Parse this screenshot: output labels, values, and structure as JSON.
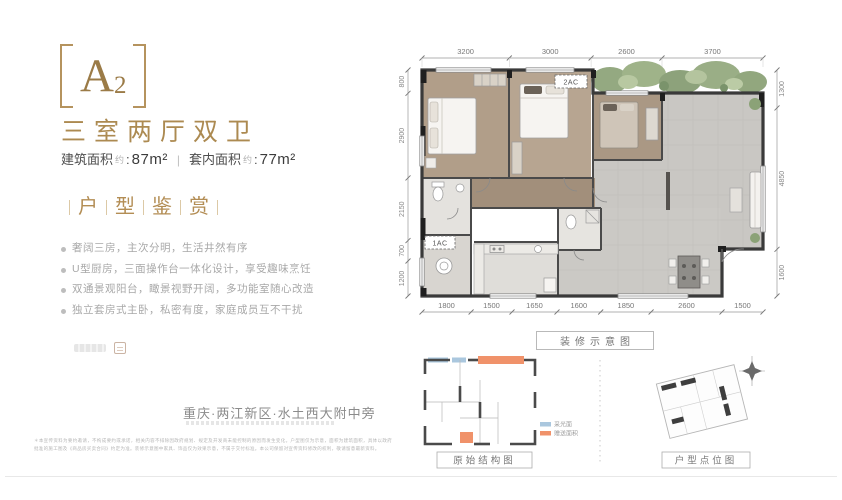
{
  "page": {
    "accent_gold": "#ac8a51",
    "wall_color": "#3a3a3a",
    "bedroom_floor": "#b2a08b",
    "living_floor": "#c9c7c3"
  },
  "unit": {
    "code_main": "A",
    "code_sub": "2",
    "type_title": "三室两厅双卫",
    "area": {
      "label1": "建筑面积",
      "approx1": "约",
      "colon1": ":",
      "value1": "87m²",
      "sep": "|",
      "label2": "套内面积",
      "approx2": "约",
      "colon2": ":",
      "value2": "77m²"
    }
  },
  "section": {
    "title_chars": [
      "户",
      "型",
      "鉴",
      "赏"
    ],
    "bullets": [
      "奢阔三房，主次分明，生活井然有序",
      "U型厨房，三面操作台一体化设计，享受趣味烹饪",
      "双通景观阳台，瞰景视野开阔，多功能室随心改造",
      "独立套房式主卧，私密有度，家庭成员互不干扰"
    ]
  },
  "location": {
    "text": "重庆·两江新区·水土西大附中旁"
  },
  "disclaimer": {
    "text": "＊本宣传资料为要约邀请，不构成要约或承诺，相关内容不排除因政府规划、规定及开发商未能控制的原因而发生变化。户型图仅为示意，面积为建筑面积，具体以政府批准的施工图及《商品房买卖合同》约定为准。装修示意图中家具、饰品仅为效果示意，不属于交付标准。本公司保留对宣传资料修改的权利，敬请留意最新资料。"
  },
  "floorplan": {
    "caption": "装修示意图",
    "ac_labels": {
      "ac2": "2AC",
      "ac1": "1AC"
    },
    "dims_top": [
      "3200",
      "3000",
      "2600",
      "3700"
    ],
    "dims_left": [
      "800",
      "2900",
      "2150",
      "700",
      "1200"
    ],
    "dims_right": [
      "1300",
      "4850",
      "1600"
    ],
    "dims_bottom": [
      "1800",
      "1500",
      "1650",
      "1600",
      "1850",
      "2600",
      "1500"
    ]
  },
  "diagrams": {
    "original": {
      "caption": "原始结构图",
      "legend": [
        {
          "label": "采光面",
          "color": "#aac7de"
        },
        {
          "label": "赠送面积",
          "color": "#f0926a"
        }
      ]
    },
    "position": {
      "caption": "户型点位图"
    }
  }
}
